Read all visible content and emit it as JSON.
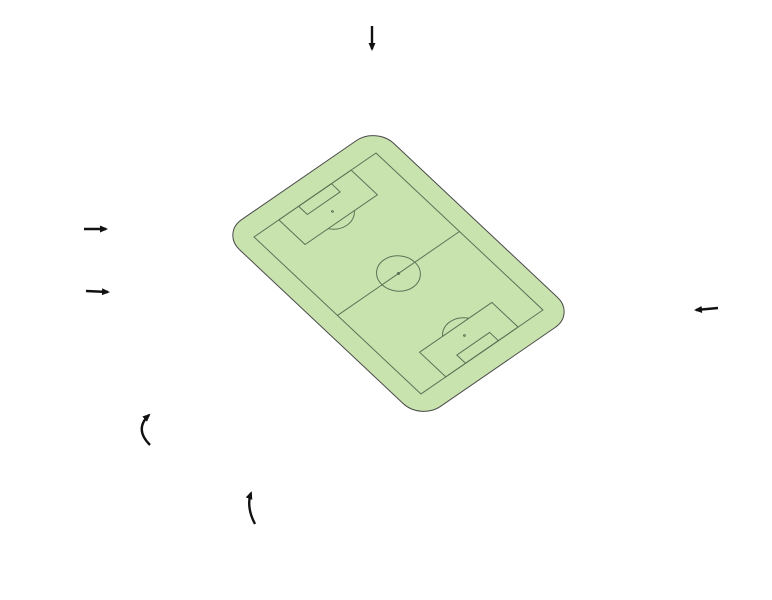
{
  "colors": {
    "red": "#E6553C",
    "teal": "#189A8B",
    "blue": "#2CA8DF",
    "yellow": "#FFE60A",
    "tan": "#B4A168",
    "white": "#FFFFFF",
    "field": "#C9E3AF",
    "pitch_line": "#5F7156"
  },
  "sections": {
    "n1A": {
      "n": "1",
      "s": "A"
    },
    "n1B": {
      "n": "1",
      "s": "B"
    },
    "n2": {
      "n": "2",
      "s": ""
    },
    "n3": {
      "n": "3",
      "s": ""
    },
    "n4": {
      "n": "4",
      "s": ""
    },
    "n5": {
      "n": "5",
      "s": ""
    },
    "n6": {
      "n": "6",
      "s": ""
    },
    "n7": {
      "n": "7",
      "s": ""
    },
    "n8": {
      "n": "8",
      "s": ""
    },
    "n9": {
      "n": "9",
      "s": ""
    },
    "n10A": {
      "n": "10",
      "s": "A"
    },
    "n10B": {
      "n": "10",
      "s": "B"
    },
    "n11A": {
      "n": "11",
      "s": "A"
    },
    "n11B": {
      "n": "11",
      "s": "B"
    },
    "n12": {
      "n": "12",
      "s": ""
    },
    "n13": {
      "n": "13",
      "s": ""
    },
    "n14": {
      "n": "14",
      "s": ""
    },
    "n15": {
      "n": "15",
      "s": ""
    },
    "n16A": {
      "n": "16",
      "s": "A"
    },
    "n16B": {
      "n": "16",
      "s": "B"
    },
    "n17B": {
      "n": "17",
      "s": "B"
    },
    "n18": {
      "n": "18",
      "s": ""
    },
    "n19": {
      "n": "19",
      "s": ""
    },
    "n20": {
      "n": "20",
      "s": ""
    },
    "n20V": {
      "n": "20",
      "s": "V"
    },
    "n21V": {
      "n": "21",
      "s": "V"
    },
    "n21": {
      "n": "21",
      "s": ""
    },
    "n22": {
      "n": "22",
      "s": ""
    },
    "n23": {
      "n": "23",
      "s": ""
    },
    "n24A": {
      "n": "24",
      "s": "A"
    },
    "n24B": {
      "n": "24",
      "s": "B"
    },
    "n25A": {
      "n": "25",
      "s": "A"
    },
    "n25B": {
      "n": "25",
      "s": "B"
    },
    "n26": {
      "n": "26",
      "s": ""
    },
    "n27": {
      "n": "27",
      "s": ""
    },
    "n28": {
      "n": "28",
      "s": ""
    },
    "n29": {
      "n": "29",
      "s": ""
    },
    "bs0": {
      "n": "BS0",
      "s": ""
    },
    "bs1": {
      "n": "BS1",
      "s": ""
    },
    "bs2": {
      "n": "BS2",
      "s": ""
    },
    "bs3": {
      "n": "BS3",
      "s": ""
    },
    "bs4": {
      "n": "BS4",
      "s": ""
    },
    "bs5": {
      "n": "BS5",
      "s": ""
    },
    "bs6": {
      "n": "BS6",
      "s": ""
    },
    "bs7": {
      "n": "BS7",
      "s": ""
    },
    "bs8": {
      "n": "BS8",
      "s": ""
    },
    "bs9": {
      "n": "BS9",
      "s": ""
    }
  },
  "bands": {
    "denis": "DENIS NEVILLE-TRIBUNE",
    "tonny": "TONNY VAN EDE-TRIBUNE",
    "bok": "BOK DE KORVER-TRIBUNE",
    "kasteeltribune": "KASTEELTRIBUNE",
    "mindervaliden": "MINDERVALIDEN",
    "rol": "ROL.",
    "beg": "BEG.",
    "kasteelloge": "KASTEELLOGE",
    "ridderzaal": "RIDDERZAAL",
    "pers": "PERS",
    "bezoekers": "BEZOEKERS",
    "businessloges": "BUSINESSLOGES 1 T/M 34"
  }
}
